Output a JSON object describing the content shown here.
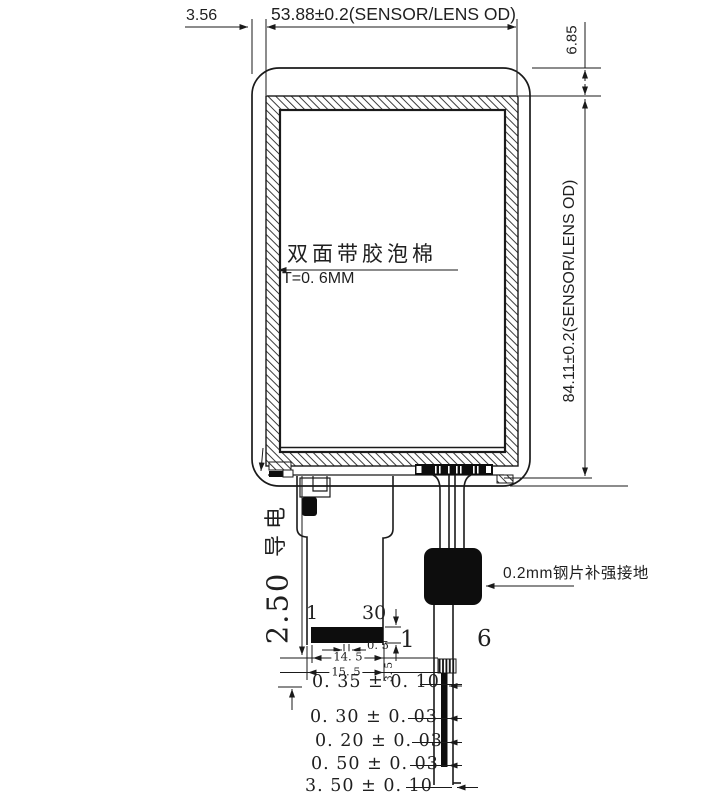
{
  "title": "LCD module outline drawing",
  "colors": {
    "line": "#1a1a1a",
    "fill_black": "#0d0d0d",
    "background": "#ffffff"
  },
  "labels": {
    "offset_left": "3.56",
    "sensor_width": "53.88±0.2(SENSOR/LENS OD)",
    "offset_top_right": "6.85",
    "sensor_height": "84.11±0.2(SENSOR/LENS OD)",
    "foam_note_line1": "双面带胶泡棉",
    "foam_note_line2": "T=0. 6MM",
    "conductive_note": "导电",
    "fpc_dim": "2.50",
    "pin_first": "1",
    "pin_last": "30",
    "connector_height": "1",
    "touch_pin_count": "6",
    "pin_pitch": "0. 5",
    "contact_width": "14. 5",
    "fpc_end_width": "15. 5",
    "tail_offset": "3. 5",
    "steel_note": "0.2mm钢片补强接地",
    "thickness_stack": [
      "0. 35 ± 0. 10",
      "0. 30 ± 0. 03",
      "0. 20 ± 0. 03",
      "0. 50 ± 0. 03",
      "3. 50 ± 0. 10"
    ]
  }
}
